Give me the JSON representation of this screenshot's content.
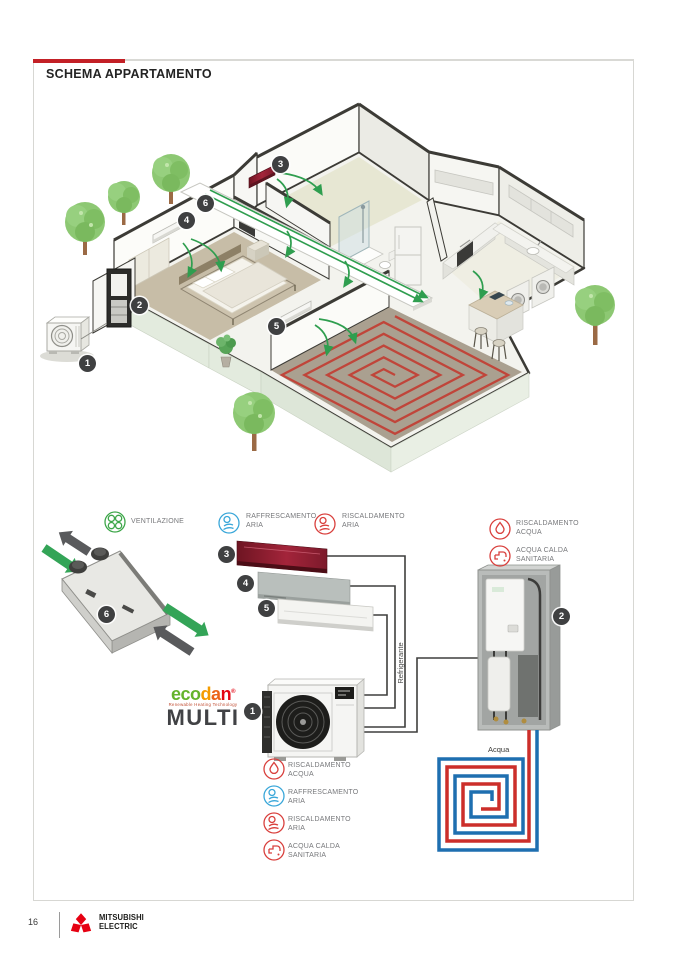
{
  "section": {
    "title": "SCHEMA APPARTAMENTO"
  },
  "badges": [
    "1",
    "2",
    "3",
    "4",
    "5",
    "6"
  ],
  "legend_top": [
    {
      "id": "ventilazione",
      "lines": [
        "VENTILAZIONE",
        ""
      ]
    },
    {
      "id": "raffrescamento-aria",
      "lines": [
        "RAFFRESCAMENTO",
        "ARIA"
      ]
    },
    {
      "id": "riscaldamento-aria",
      "lines": [
        "RISCALDAMENTO",
        "ARIA"
      ]
    },
    {
      "id": "riscaldamento-acqua",
      "lines": [
        "RISCALDAMENTO",
        "ACQUA"
      ]
    },
    {
      "id": "acqua-calda-sanitaria",
      "lines": [
        "ACQUA CALDA",
        "SANITARIA"
      ]
    }
  ],
  "legend_bottom": [
    {
      "id": "riscaldamento-acqua",
      "lines": [
        "RISCALDAMENTO",
        "ACQUA"
      ]
    },
    {
      "id": "raffrescamento-aria",
      "lines": [
        "RAFFRESCAMENTO",
        "ARIA"
      ]
    },
    {
      "id": "riscaldamento-aria",
      "lines": [
        "RISCALDAMENTO",
        "ARIA"
      ]
    },
    {
      "id": "acqua-calda-sanitaria",
      "lines": [
        "ACQUA CALDA",
        "SANITARIA"
      ]
    }
  ],
  "diagram": {
    "refrigerante": "Refrigerante",
    "acqua": "Acqua"
  },
  "brand": {
    "eco": "eco",
    "d": "d",
    "a": "a",
    "n": "n",
    "reg": "®",
    "tagline": "Renewable Heating Technology",
    "product": "MULTI"
  },
  "footer": {
    "page_number": "16",
    "brand_line1": "MITSUBISHI",
    "brand_line2": "ELECTRIC"
  },
  "colors": {
    "accent_red": "#c32026",
    "mitsubishi_red": "#e60012",
    "green": "#2f9e4f",
    "gray_arrow": "#595a5c",
    "blue": "#3aa7d9",
    "icon_red": "#d9403d",
    "pipe_red": "#cc2e2a",
    "pipe_blue": "#1e6fb0",
    "badge": "#3f4041",
    "floor_heating_red": "#c23e33"
  }
}
